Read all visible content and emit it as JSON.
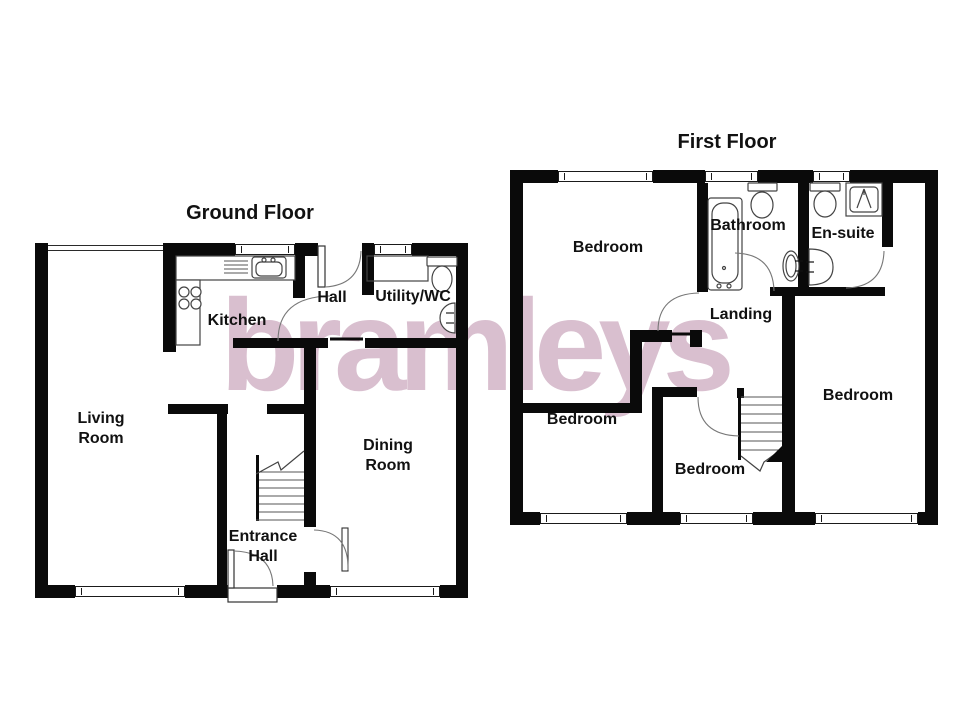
{
  "watermark": {
    "text": "bramleys",
    "color": "#d9bfcf"
  },
  "ground_floor": {
    "title": "Ground Floor",
    "rooms": {
      "living_room": "Living Room",
      "kitchen": "Kitchen",
      "hall": "Hall",
      "utility_wc": "Utility/WC",
      "dining_room": "Dining Room",
      "entrance_hall": "Entrance Hall"
    }
  },
  "first_floor": {
    "title": "First Floor",
    "rooms": {
      "bedroom_front": "Bedroom",
      "bathroom": "Bathroom",
      "en_suite": "En-suite",
      "landing": "Landing",
      "bedroom_left": "Bedroom",
      "bedroom_middle": "Bedroom",
      "bedroom_right": "Bedroom"
    }
  },
  "fixtures": {
    "ground_floor": [
      "kitchen-sink",
      "kitchen-drainer",
      "kitchen-hob",
      "kitchen-counter",
      "utility-worktop",
      "utility-toilet",
      "utility-basin",
      "staircase",
      "front-door",
      "rear-door",
      "interior-doors"
    ],
    "first_floor": [
      "bathtub",
      "bathroom-toilet",
      "bathroom-basin",
      "ensuite-toilet",
      "ensuite-basin",
      "shower",
      "staircase",
      "interior-doors"
    ]
  },
  "colors": {
    "background": "#ffffff",
    "wall": "#0a0a0a",
    "fixture_line": "#444444",
    "watermark": "#d9bfcf"
  }
}
